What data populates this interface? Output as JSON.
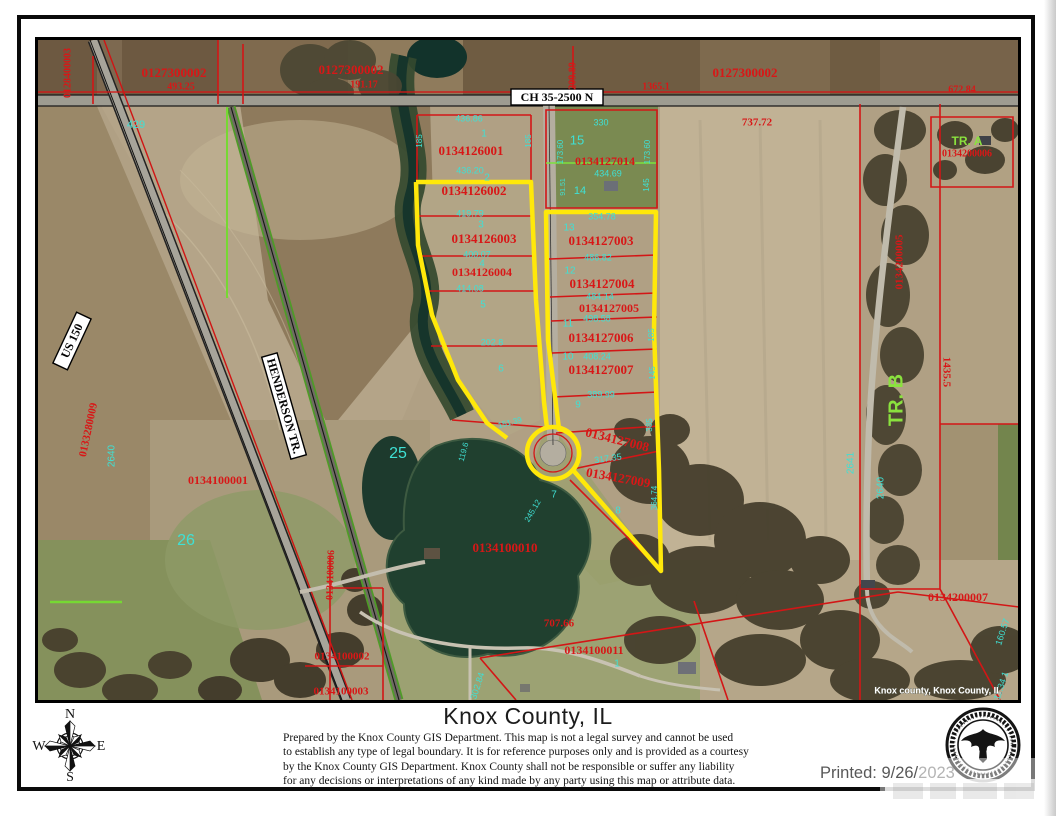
{
  "footer": {
    "title": "Knox County, IL",
    "disclaimer_lines": [
      "Prepared by the Knox County GIS Department. This map is not a legal survey and cannot be used",
      "to establish any type of legal boundary. It is for reference purposes only and is provided as a courtesy",
      "by the Knox County GIS Department.  Knox County shall not be responsible or suffer any liability",
      "for any decisions or interpretations of any kind made by any party using this map or attribute data."
    ],
    "printed_prefix": "Printed: 9/26/",
    "printed_year": "2023",
    "compass": {
      "n": "N",
      "e": "E",
      "s": "S",
      "w": "W"
    }
  },
  "map": {
    "credit": "Knox county, Knox County, IL",
    "road_signs": [
      {
        "name": "road-sign-ch-35-2500-n",
        "text": "CH 35-2500 N"
      },
      {
        "name": "road-sign-us-150",
        "text": "US 150"
      },
      {
        "name": "road-sign-henderson-tr",
        "text": "HENDERSON TR."
      }
    ],
    "labels": [
      {
        "name": "parcel-0128400003",
        "text": "0128400003",
        "x": 68,
        "y": 73,
        "r": -90,
        "cls": "red",
        "size": 10
      },
      {
        "name": "parcel-0127300002-w",
        "text": "0127300002",
        "x": 174,
        "y": 74,
        "cls": "red",
        "size": 13
      },
      {
        "name": "dim-493-25",
        "text": "493.25",
        "x": 181,
        "y": 87,
        "cls": "red",
        "size": 10
      },
      {
        "name": "parcel-0127300002-m",
        "text": "0127300002",
        "x": 351,
        "y": 71,
        "cls": "red",
        "size": 13
      },
      {
        "name": "dim-191-17",
        "text": "191.17",
        "x": 364,
        "y": 85,
        "cls": "red",
        "size": 10
      },
      {
        "name": "parcel-0127300002-e",
        "text": "0127300002",
        "x": 745,
        "y": 74,
        "cls": "red",
        "size": 13
      },
      {
        "name": "dim-1365-1",
        "text": "1365.1",
        "x": 656,
        "y": 87,
        "cls": "red",
        "size": 10
      },
      {
        "name": "dim-672-84",
        "text": "672.84",
        "x": 962,
        "y": 90,
        "cls": "red",
        "size": 10
      },
      {
        "name": "dim-209-89",
        "text": "209.89",
        "x": 573,
        "y": 76,
        "r": -90,
        "cls": "red",
        "size": 10
      },
      {
        "name": "dim-737-72",
        "text": "737.72",
        "x": 757,
        "y": 123,
        "cls": "red",
        "size": 11
      },
      {
        "name": "parcel-0134126001",
        "text": "0134126001",
        "x": 471,
        "y": 152,
        "cls": "red",
        "size": 13
      },
      {
        "name": "parcel-0134126002",
        "text": "0134126002",
        "x": 474,
        "y": 192,
        "cls": "red",
        "size": 13
      },
      {
        "name": "parcel-0134126003",
        "text": "0134126003",
        "x": 484,
        "y": 240,
        "cls": "red",
        "size": 13
      },
      {
        "name": "parcel-0134126004",
        "text": "0134126004",
        "x": 482,
        "y": 273,
        "cls": "red",
        "size": 12
      },
      {
        "name": "parcel-0134127014",
        "text": "0134127014",
        "x": 605,
        "y": 162,
        "cls": "red",
        "size": 12
      },
      {
        "name": "parcel-0134127003",
        "text": "0134127003",
        "x": 601,
        "y": 242,
        "cls": "red",
        "size": 13
      },
      {
        "name": "parcel-0134127004",
        "text": "0134127004",
        "x": 602,
        "y": 285,
        "cls": "red",
        "size": 13
      },
      {
        "name": "parcel-0134127005",
        "text": "0134127005",
        "x": 609,
        "y": 309,
        "cls": "red",
        "size": 12
      },
      {
        "name": "parcel-0134127006",
        "text": "0134127006",
        "x": 601,
        "y": 339,
        "cls": "red",
        "size": 13
      },
      {
        "name": "parcel-0134127007",
        "text": "0134127007",
        "x": 601,
        "y": 371,
        "cls": "red",
        "size": 13
      },
      {
        "name": "parcel-0134127008",
        "text": "0134127008",
        "x": 617,
        "y": 441,
        "r": 14,
        "cls": "red",
        "size": 13
      },
      {
        "name": "parcel-0134127009",
        "text": "0134127009",
        "x": 618,
        "y": 479,
        "r": 10,
        "cls": "red",
        "size": 13
      },
      {
        "name": "parcel-0134100001",
        "text": "0134100001",
        "x": 218,
        "y": 481,
        "cls": "red",
        "size": 12
      },
      {
        "name": "parcel-0134100010",
        "text": "0134100010",
        "x": 505,
        "y": 549,
        "cls": "red",
        "size": 13
      },
      {
        "name": "dim-707-66",
        "text": "707.66",
        "x": 559,
        "y": 624,
        "cls": "red",
        "size": 11
      },
      {
        "name": "parcel-0134100011",
        "text": "0134100011",
        "x": 594,
        "y": 651,
        "cls": "red",
        "size": 12
      },
      {
        "name": "parcel-0134200007",
        "text": "0134200007",
        "x": 958,
        "y": 598,
        "cls": "red",
        "size": 12
      },
      {
        "name": "parcel-0134100002",
        "text": "0134100002",
        "x": 342,
        "y": 657,
        "cls": "red",
        "size": 11
      },
      {
        "name": "parcel-0134100003",
        "text": "0134100003",
        "x": 341,
        "y": 692,
        "cls": "red",
        "size": 11
      },
      {
        "name": "dim-1435-5",
        "text": "1435.5",
        "x": 946,
        "y": 372,
        "r": 90,
        "cls": "red",
        "size": 11
      },
      {
        "name": "parcel-0133280009",
        "text": "0133280009",
        "x": 89,
        "y": 430,
        "r": -78,
        "cls": "red",
        "size": 11
      },
      {
        "name": "parcel-0134200005",
        "text": "0134200005",
        "x": 900,
        "y": 262,
        "r": -90,
        "cls": "red",
        "size": 11
      },
      {
        "name": "parcel-0134100006",
        "text": "0134100006",
        "x": 331,
        "y": 575,
        "r": -88,
        "cls": "red",
        "size": 10
      },
      {
        "name": "parcel-0134200006",
        "text": "0134200006",
        "x": 967,
        "y": 154,
        "cls": "red",
        "size": 10
      },
      {
        "name": "dim-429",
        "text": "429",
        "x": 136,
        "y": 125,
        "cls": "cyan",
        "size": 11
      },
      {
        "name": "dim-436-86",
        "text": "436.86",
        "x": 469,
        "y": 119,
        "cls": "cyan",
        "size": 9
      },
      {
        "name": "lot-1",
        "text": "1",
        "x": 484,
        "y": 134,
        "cls": "cyan",
        "size": 10
      },
      {
        "name": "dim-185-w",
        "text": "185",
        "x": 420,
        "y": 141,
        "r": -90,
        "cls": "cyan",
        "size": 8
      },
      {
        "name": "dim-185-e",
        "text": "185",
        "x": 529,
        "y": 141,
        "r": -90,
        "cls": "cyan",
        "size": 8
      },
      {
        "name": "dim-436-20",
        "text": "436.20",
        "x": 470,
        "y": 171,
        "cls": "cyan",
        "size": 9
      },
      {
        "name": "lot-2",
        "text": "2",
        "x": 487,
        "y": 178,
        "cls": "cyan",
        "size": 10
      },
      {
        "name": "dim-419-79",
        "text": "419.79",
        "x": 470,
        "y": 214,
        "cls": "cyan",
        "size": 9
      },
      {
        "name": "lot-3",
        "text": "3",
        "x": 481,
        "y": 225,
        "cls": "cyan",
        "size": 10
      },
      {
        "name": "dim-400-07",
        "text": "400.07",
        "x": 477,
        "y": 255,
        "cls": "cyan",
        "size": 9
      },
      {
        "name": "lot-4",
        "text": "4",
        "x": 482,
        "y": 264,
        "cls": "cyan",
        "size": 10
      },
      {
        "name": "dim-414-08",
        "text": "414.08",
        "x": 470,
        "y": 289,
        "cls": "cyan",
        "size": 9
      },
      {
        "name": "lot-5",
        "text": "5",
        "x": 483,
        "y": 305,
        "cls": "cyan",
        "size": 10
      },
      {
        "name": "dim-202-8",
        "text": "202.8",
        "x": 492,
        "y": 343,
        "cls": "cyan",
        "size": 9
      },
      {
        "name": "lot-6",
        "text": "6",
        "x": 501,
        "y": 369,
        "cls": "cyan",
        "size": 10
      },
      {
        "name": "dim-151-39",
        "text": "151.39",
        "x": 510,
        "y": 423,
        "r": -15,
        "cls": "cyan",
        "size": 8
      },
      {
        "name": "dim-119-6",
        "text": "119.6",
        "x": 464,
        "y": 452,
        "r": -75,
        "cls": "cyan",
        "size": 8
      },
      {
        "name": "dim-330",
        "text": "330",
        "x": 601,
        "y": 123,
        "cls": "cyan",
        "size": 9
      },
      {
        "name": "lot-15",
        "text": "15",
        "x": 577,
        "y": 141,
        "cls": "cyan",
        "size": 13
      },
      {
        "name": "dim-173-60-w",
        "text": "173.60",
        "x": 561,
        "y": 152,
        "r": -90,
        "cls": "cyan",
        "size": 8
      },
      {
        "name": "dim-173-60-e",
        "text": "173.60",
        "x": 648,
        "y": 152,
        "r": -90,
        "cls": "cyan",
        "size": 8
      },
      {
        "name": "dim-434-69",
        "text": "434.69",
        "x": 608,
        "y": 174,
        "cls": "cyan",
        "size": 9
      },
      {
        "name": "lot-14",
        "text": "14",
        "x": 580,
        "y": 191,
        "cls": "cyan",
        "size": 11
      },
      {
        "name": "dim-91-51",
        "text": "91.51",
        "x": 563,
        "y": 187,
        "r": -90,
        "cls": "cyan",
        "size": 7
      },
      {
        "name": "dim-145-a",
        "text": "145",
        "x": 647,
        "y": 185,
        "r": -90,
        "cls": "cyan",
        "size": 8
      },
      {
        "name": "dim-354-78",
        "text": "354.78",
        "x": 602,
        "y": 217,
        "cls": "cyan",
        "size": 9
      },
      {
        "name": "lot-13",
        "text": "13",
        "x": 569,
        "y": 228,
        "cls": "cyan",
        "size": 10
      },
      {
        "name": "dim-486-82",
        "text": "486.82",
        "x": 598,
        "y": 258,
        "cls": "cyan",
        "size": 9
      },
      {
        "name": "lot-12",
        "text": "12",
        "x": 570,
        "y": 271,
        "cls": "cyan",
        "size": 10
      },
      {
        "name": "dim-484-14",
        "text": "484.14",
        "x": 600,
        "y": 297,
        "cls": "cyan",
        "size": 9
      },
      {
        "name": "dim-498-58",
        "text": "498.58",
        "x": 597,
        "y": 319,
        "cls": "cyan",
        "size": 9
      },
      {
        "name": "lot-11",
        "text": "11",
        "x": 568,
        "y": 324,
        "cls": "cyan",
        "size": 10
      },
      {
        "name": "dim-408-24",
        "text": "408.24",
        "x": 597,
        "y": 357,
        "cls": "cyan",
        "size": 9
      },
      {
        "name": "lot-10",
        "text": "10",
        "x": 568,
        "y": 357,
        "cls": "cyan",
        "size": 10
      },
      {
        "name": "dim-185-c",
        "text": "185",
        "x": 652,
        "y": 335,
        "r": -90,
        "cls": "cyan",
        "size": 8
      },
      {
        "name": "dim-145-b",
        "text": "145",
        "x": 653,
        "y": 373,
        "r": -90,
        "cls": "cyan",
        "size": 8
      },
      {
        "name": "dim-389-99",
        "text": "389.99",
        "x": 601,
        "y": 395,
        "cls": "cyan",
        "size": 9
      },
      {
        "name": "lot-9",
        "text": "9",
        "x": 578,
        "y": 405,
        "cls": "cyan",
        "size": 10
      },
      {
        "name": "dim-385",
        "text": "385",
        "x": 650,
        "y": 425,
        "r": -90,
        "cls": "cyan",
        "size": 8
      },
      {
        "name": "dim-317-35",
        "text": "317.35",
        "x": 608,
        "y": 459,
        "r": -8,
        "cls": "cyan",
        "size": 9
      },
      {
        "name": "dim-364-74",
        "text": "364.74",
        "x": 655,
        "y": 498,
        "r": -90,
        "cls": "cyan",
        "size": 8
      },
      {
        "name": "dim-245-12",
        "text": "245.12",
        "x": 533,
        "y": 511,
        "r": -60,
        "cls": "cyan",
        "size": 8
      },
      {
        "name": "lot-7",
        "text": "7",
        "x": 554,
        "y": 495,
        "cls": "cyan",
        "size": 10
      },
      {
        "name": "lot-8",
        "text": "8",
        "x": 618,
        "y": 511,
        "cls": "cyan",
        "size": 10
      },
      {
        "name": "section-25",
        "text": "25",
        "x": 398,
        "y": 454,
        "cls": "cyan",
        "size": 16
      },
      {
        "name": "section-26",
        "text": "26",
        "x": 186,
        "y": 541,
        "cls": "cyan",
        "size": 16
      },
      {
        "name": "dim-2640-w",
        "text": "2640",
        "x": 112,
        "y": 456,
        "r": -90,
        "cls": "cyan",
        "size": 10
      },
      {
        "name": "dim-2641",
        "text": "2641",
        "x": 851,
        "y": 463,
        "r": -90,
        "cls": "cyan",
        "size": 10
      },
      {
        "name": "dim-2640-e",
        "text": "2640",
        "x": 881,
        "y": 488,
        "r": -90,
        "cls": "cyan",
        "size": 10
      },
      {
        "name": "dim-302-84",
        "text": "302.84",
        "x": 478,
        "y": 686,
        "r": -72,
        "cls": "cyan",
        "size": 9
      },
      {
        "name": "dim-160-57",
        "text": "160.57",
        "x": 1003,
        "y": 632,
        "r": -72,
        "cls": "cyan",
        "size": 9
      },
      {
        "name": "dim-111-34",
        "text": "111.34 1",
        "x": 1001,
        "y": 688,
        "r": -72,
        "cls": "cyan",
        "size": 9
      },
      {
        "name": "lot-1-south",
        "text": "1",
        "x": 617,
        "y": 664,
        "cls": "cyan",
        "size": 10
      },
      {
        "name": "tract-a",
        "text": "TR. A",
        "x": 967,
        "y": 142,
        "cls": "green",
        "size": 12
      },
      {
        "name": "tract-b",
        "text": "TR. B",
        "x": 897,
        "y": 400,
        "r": -90,
        "cls": "green",
        "size": 20
      },
      {
        "name": "map-credit",
        "text": "Knox county, Knox County, IL",
        "x": 938,
        "y": 691,
        "cls": "white",
        "size": 9
      }
    ]
  },
  "colors": {
    "parcel_red": "#d81717",
    "dimension_cyan": "#3fe0d4",
    "tract_green": "#8ae23e",
    "subdivision_yellow": "#ffe80a"
  }
}
